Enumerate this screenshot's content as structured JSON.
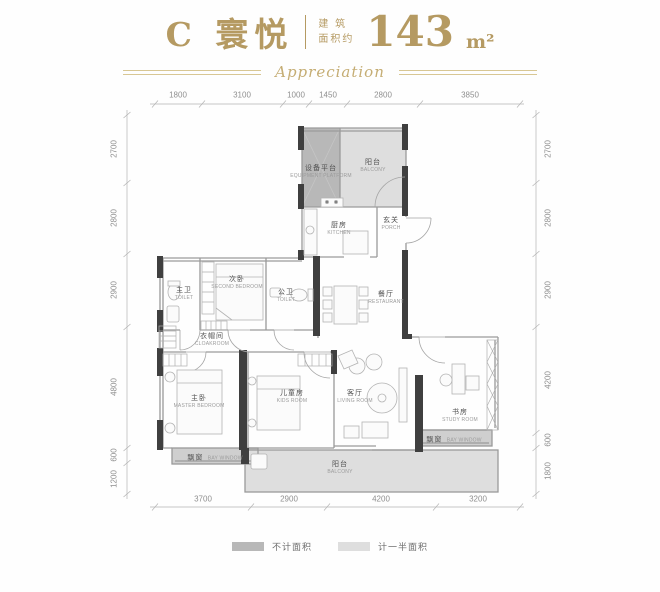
{
  "header": {
    "title": "C 寰悦",
    "area_label_line1": "建 筑",
    "area_label_line2": "面积约",
    "area_value": "143",
    "area_unit": "m²",
    "tagline": "Appreciation"
  },
  "dimensions": {
    "top": [
      "1800",
      "3100",
      "1000",
      "1450",
      "2800",
      "3850"
    ],
    "bottom": [
      "3700",
      "2900",
      "4200",
      "3200"
    ],
    "left": [
      "2700",
      "2800",
      "2900",
      "4800",
      "600",
      "1200"
    ],
    "right": [
      "2700",
      "2800",
      "2900",
      "4200",
      "600",
      "1800"
    ]
  },
  "rooms": {
    "equipment_platform": {
      "zh": "设备平台",
      "en": "EQUIPMENT PLATFORM"
    },
    "balcony_top": {
      "zh": "阳台",
      "en": "BALCONY"
    },
    "kitchen": {
      "zh": "厨房",
      "en": "KITCHEN"
    },
    "porch": {
      "zh": "玄关",
      "en": "PORCH"
    },
    "master_toilet": {
      "zh": "主卫",
      "en": "TOILET"
    },
    "second_bedroom": {
      "zh": "次卧",
      "en": "SECOND BEDROOM"
    },
    "public_toilet": {
      "zh": "公卫",
      "en": "TOILET"
    },
    "restaurant": {
      "zh": "餐厅",
      "en": "RESTAURANT"
    },
    "cloakroom": {
      "zh": "衣帽间",
      "en": "CLOAKROOM"
    },
    "master_bedroom": {
      "zh": "主卧",
      "en": "MASTER BEDROOM"
    },
    "kids_room": {
      "zh": "儿童房",
      "en": "KIDS ROOM"
    },
    "living_room": {
      "zh": "客厅",
      "en": "LIVING ROOM"
    },
    "study_room": {
      "zh": "书房",
      "en": "STUDY ROOM"
    },
    "bay_window_left": {
      "zh": "飘窗",
      "en": "BAY WINDOW"
    },
    "bay_window_right": {
      "zh": "飘窗",
      "en": "BAY WINDOW"
    },
    "balcony_bottom": {
      "zh": "阳台",
      "en": "BALCONY"
    }
  },
  "legend": {
    "not_counted": "不计面积",
    "half_counted": "计一半面积"
  },
  "colors": {
    "gold": "#b59a62",
    "wall_dark": "#3f3f3f",
    "line_gray": "#9a9a9a",
    "fill_not_counted": "#b8b8b8",
    "fill_half_counted": "#dedede"
  }
}
